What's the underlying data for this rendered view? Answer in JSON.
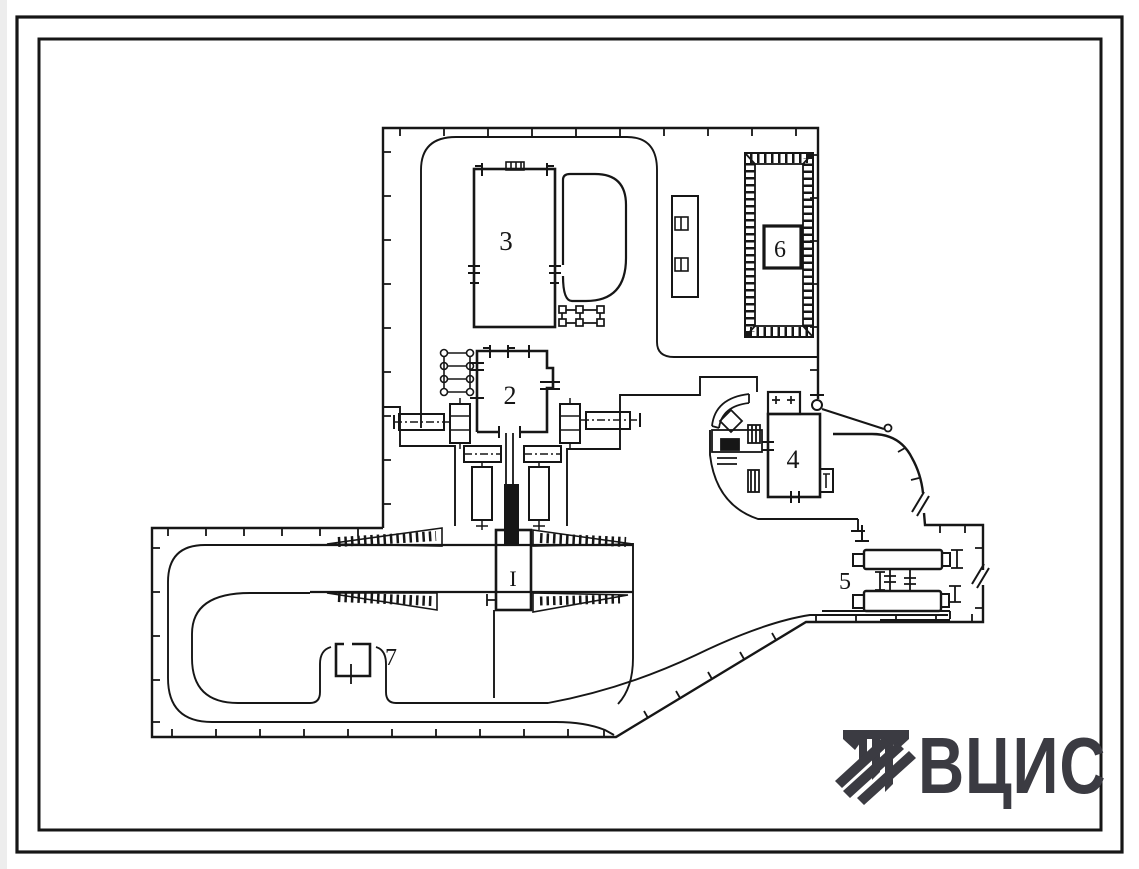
{
  "drawing": {
    "type": "site-plan",
    "ink": "#161616",
    "background": "#ffffff",
    "labels": [
      {
        "id": "building-1",
        "text": "I"
      },
      {
        "id": "building-2",
        "text": "2"
      },
      {
        "id": "building-3",
        "text": "3"
      },
      {
        "id": "building-4",
        "text": "4"
      },
      {
        "id": "building-5",
        "text": "5"
      },
      {
        "id": "building-6",
        "text": "6"
      },
      {
        "id": "building-7",
        "text": "7"
      }
    ],
    "logo": {
      "text": "ВЦИС",
      "color": "#3b3b42"
    }
  }
}
